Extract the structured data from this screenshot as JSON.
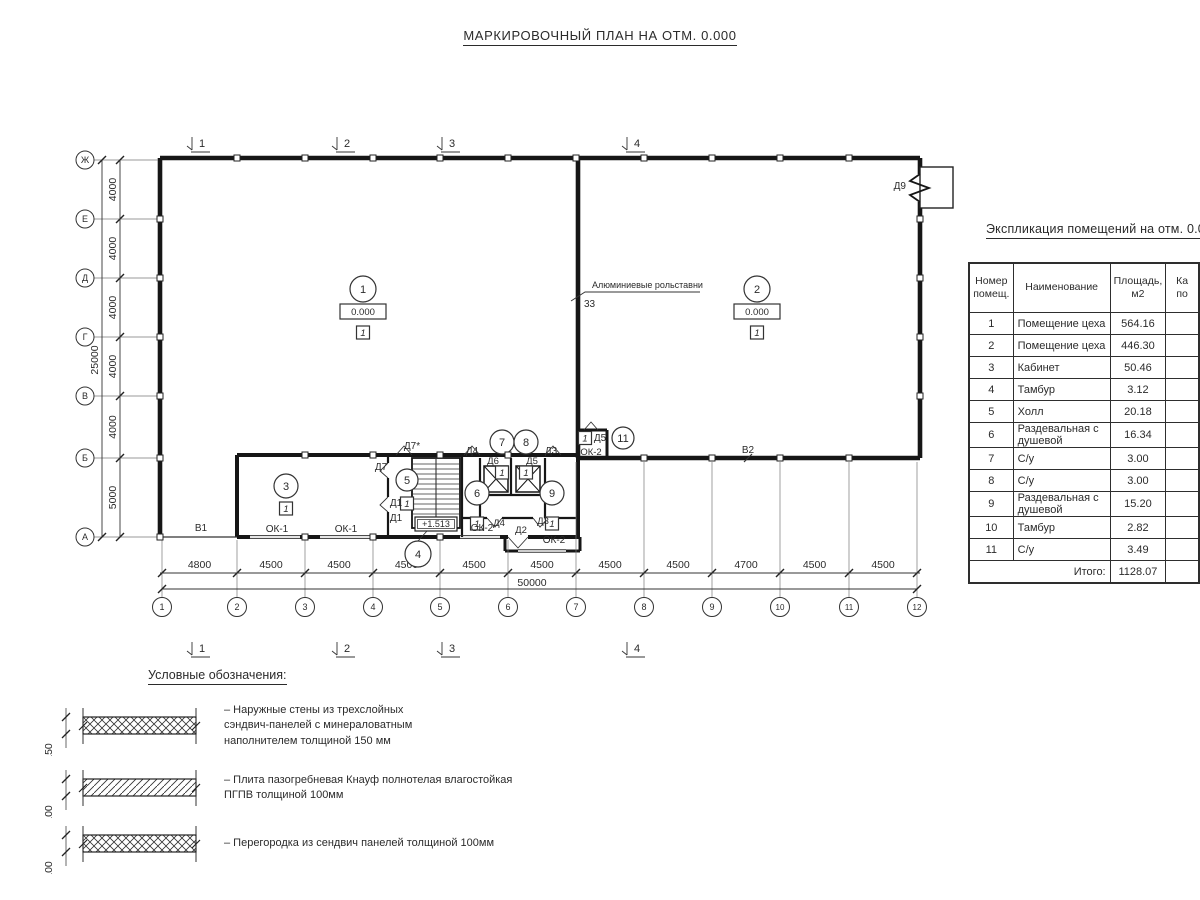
{
  "title": "МАРКИРОВОЧНЫЙ ПЛАН НА ОТМ. 0.000",
  "schedule": {
    "title": "Экспликация помещений на отм. 0.000",
    "col_num": "Номер\nпомещ.",
    "col_name": "Наименование",
    "col_area": "Площадь,\nм2",
    "col_cat": "Ка\nпо",
    "rows": [
      [
        "1",
        "Помещение цеха",
        "564.16"
      ],
      [
        "2",
        "Помещение цеха",
        "446.30"
      ],
      [
        "3",
        "Кабинет",
        "50.46"
      ],
      [
        "4",
        "Тамбур",
        "3.12"
      ],
      [
        "5",
        "Холл",
        "20.18"
      ],
      [
        "6",
        "Раздевальная с душевой",
        "16.34"
      ],
      [
        "7",
        "С/у",
        "3.00"
      ],
      [
        "8",
        "С/у",
        "3.00"
      ],
      [
        "9",
        "Раздевальная с душевой",
        "15.20"
      ],
      [
        "10",
        "Тамбур",
        "2.82"
      ],
      [
        "11",
        "С/у",
        "3.49"
      ]
    ],
    "total_label": "Итого:",
    "total_value": "1128.07"
  },
  "plan": {
    "axis_rows": [
      {
        "label": "Ж",
        "y": 160
      },
      {
        "label": "Е",
        "y": 219
      },
      {
        "label": "Д",
        "y": 278
      },
      {
        "label": "Г",
        "y": 337
      },
      {
        "label": "В",
        "y": 396
      },
      {
        "label": "Б",
        "y": 458
      },
      {
        "label": "А",
        "y": 537
      }
    ],
    "row_dims": [
      "4000",
      "4000",
      "4000",
      "4000",
      "4000",
      "5000"
    ],
    "row_total": "25000",
    "axis_cols": [
      {
        "label": "1",
        "x": 162
      },
      {
        "label": "2",
        "x": 237
      },
      {
        "label": "3",
        "x": 305
      },
      {
        "label": "4",
        "x": 373
      },
      {
        "label": "5",
        "x": 440
      },
      {
        "label": "6",
        "x": 508
      },
      {
        "label": "7",
        "x": 576
      },
      {
        "label": "8",
        "x": 644
      },
      {
        "label": "9",
        "x": 712
      },
      {
        "label": "10",
        "x": 780
      },
      {
        "label": "11",
        "x": 849
      },
      {
        "label": "12",
        "x": 917
      }
    ],
    "col_dims": [
      "4800",
      "4500",
      "4500",
      "4500",
      "4500",
      "4500",
      "4500",
      "4500",
      "4700",
      "4500",
      "4500"
    ],
    "col_total": "50000",
    "section_markers": [
      {
        "label": "1",
        "x": 195
      },
      {
        "label": "2",
        "x": 340
      },
      {
        "label": "3",
        "x": 445
      },
      {
        "label": "4",
        "x": 630
      }
    ],
    "room_markers": [
      {
        "num": "1",
        "x": 363,
        "y": 289,
        "r": 13,
        "elev": "0.000",
        "cls": "1"
      },
      {
        "num": "2",
        "x": 757,
        "y": 289,
        "r": 13,
        "elev": "0.000",
        "cls": "1"
      },
      {
        "num": "3",
        "x": 286,
        "y": 486,
        "r": 12,
        "cls": "1"
      },
      {
        "num": "4",
        "x": 418,
        "y": 554,
        "r": 13,
        "leader": [
          418,
          541,
          427,
          531
        ]
      },
      {
        "num": "5",
        "x": 407,
        "y": 480,
        "r": 11,
        "cls": "1",
        "clsdy": 17
      },
      {
        "num": "6",
        "x": 477,
        "y": 493,
        "r": 12,
        "cls": "1",
        "clsdy": 24
      },
      {
        "num": "7",
        "x": 502,
        "y": 442,
        "r": 12,
        "cls": "1",
        "clsdy": 24
      },
      {
        "num": "8",
        "x": 526,
        "y": 442,
        "r": 12,
        "cls": "1",
        "clsdy": 24
      },
      {
        "num": "9",
        "x": 552,
        "y": 493,
        "r": 12,
        "cls": "1",
        "clsdy": 24
      },
      {
        "num": "11",
        "x": 623,
        "y": 438,
        "r": 11
      }
    ],
    "cls_boxes": [
      {
        "x": 585,
        "y": 438,
        "label": "1"
      }
    ],
    "labels": [
      {
        "t": "Д9",
        "x": 906,
        "y": 189,
        "a": "end"
      },
      {
        "t": "Д7*",
        "x": 412,
        "y": 449
      },
      {
        "t": "Д7",
        "x": 381,
        "y": 470
      },
      {
        "t": "Д1",
        "x": 396,
        "y": 506
      },
      {
        "t": "Д1",
        "x": 396,
        "y": 521
      },
      {
        "t": "Д4",
        "x": 472,
        "y": 454
      },
      {
        "t": "Д3",
        "x": 551,
        "y": 454
      },
      {
        "t": "Д6",
        "x": 493,
        "y": 464,
        "s": 9.5
      },
      {
        "t": "Д5",
        "x": 532,
        "y": 464,
        "s": 9.5
      },
      {
        "t": "Д5",
        "x": 600,
        "y": 441
      },
      {
        "t": "ОК-2",
        "x": 591,
        "y": 455,
        "s": 9.5
      },
      {
        "t": "В2",
        "x": 748,
        "y": 453
      },
      {
        "t": "В1",
        "x": 201,
        "y": 531
      },
      {
        "t": "ОК-1",
        "x": 277,
        "y": 532
      },
      {
        "t": "ОК-1",
        "x": 346,
        "y": 532
      },
      {
        "t": "ОК-2",
        "x": 482,
        "y": 531
      },
      {
        "t": "Д4",
        "x": 499,
        "y": 526,
        "s": 9.5
      },
      {
        "t": "Д2",
        "x": 521,
        "y": 533,
        "s": 9.5
      },
      {
        "t": "Д3",
        "x": 543,
        "y": 524,
        "s": 9.5
      },
      {
        "t": "ОК-2",
        "x": 554,
        "y": 543
      },
      {
        "t": "33",
        "x": 584,
        "y": 307,
        "a": "start"
      },
      {
        "t": "Алюминиевые рольставни",
        "x": 592,
        "y": 288,
        "a": "start",
        "s": 9
      }
    ],
    "stair_elev": "+1.513"
  },
  "legend": {
    "title": "Условные обозначения:",
    "items": [
      {
        "thickness": "150",
        "text": "–  Наружные стены из трехслойных\nсэндвич-панелей с минераловатным\nнаполнителем толщиной 150 мм"
      },
      {
        "thickness": "100",
        "text": "–  Плита пазогребневая Кнауф полнотелая влагостойкая\nПГПВ толщиной 100мм"
      },
      {
        "thickness": "100",
        "text": "–  Перегородка из сендвич панелей толщиной 100мм"
      }
    ]
  }
}
